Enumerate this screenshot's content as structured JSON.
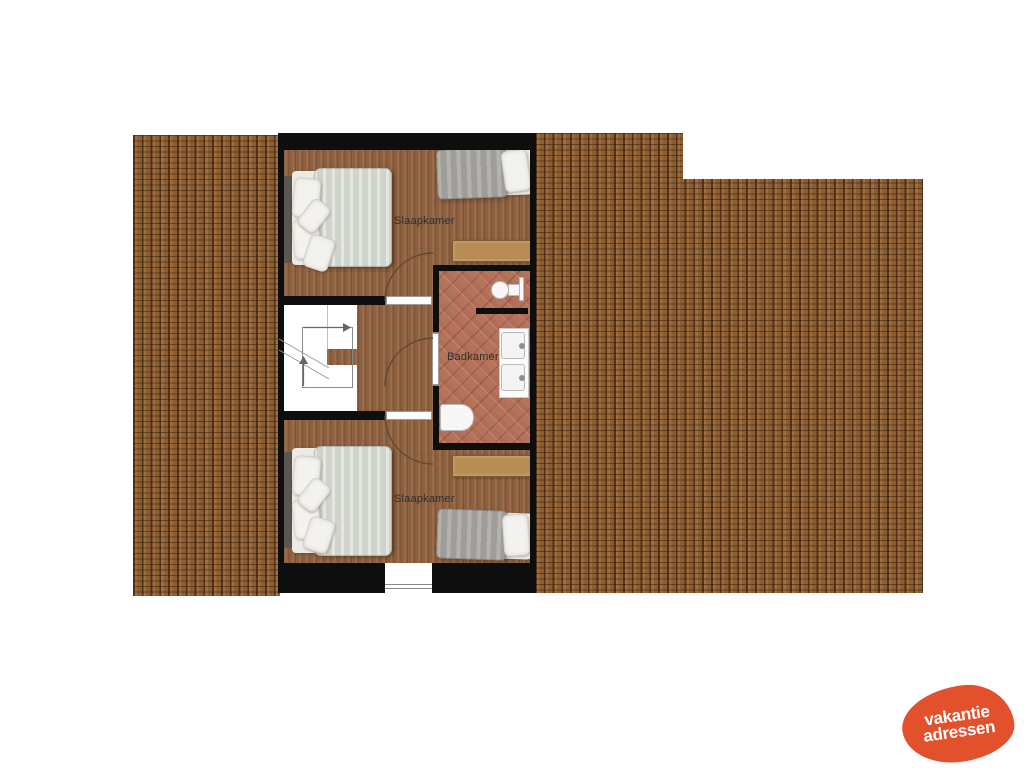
{
  "plan": {
    "type": "floorplan-upper-storey",
    "rooms": [
      {
        "id": "slaapkamer-top",
        "label": "Slaapkamer"
      },
      {
        "id": "badkamer",
        "label": "Badkamer"
      },
      {
        "id": "slaapkamer-bottom",
        "label": "Slaapkamer"
      }
    ]
  },
  "logo": {
    "line1": "vakantie",
    "line2": "adressen"
  },
  "colors": {
    "wall": "#0e0e0e",
    "roof-base": "#9c6b3c",
    "floor-base": "#8d6040",
    "bath-base": "#b5735c",
    "duvet-light": "#d9dcd3",
    "duvet-gray": "#a7a5a1",
    "pillow": "#f3f2ee",
    "headboard": "#5b574f",
    "bench": "#b78d54",
    "label": "#2e2e2e",
    "logo": "#e2512c"
  }
}
